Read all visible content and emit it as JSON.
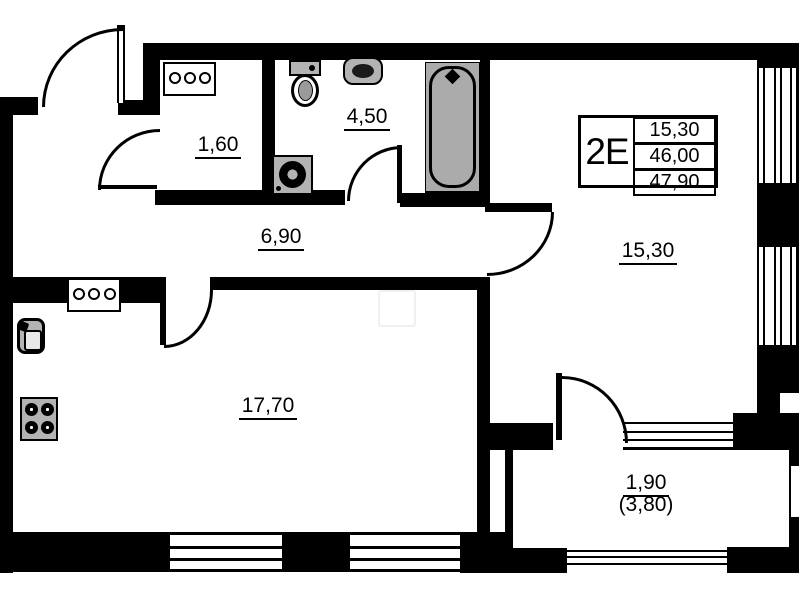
{
  "unit_info": {
    "unit_type": "2E",
    "rows": [
      "15,30",
      "46,00",
      "47,90"
    ]
  },
  "room_labels": {
    "closet": "1,60",
    "bathroom": "4,50",
    "hallway": "6,90",
    "room": "15,30",
    "kitchen_living": "17,70",
    "balcony": "1,90",
    "balcony_total": "(3,80)"
  },
  "colors": {
    "wall": "#000000",
    "fixture_fill": "#b3b3b3",
    "bathtub_fill": "#ababab",
    "background": "#ffffff"
  },
  "symbols": [
    "entrance-door",
    "closet-door",
    "bathroom-door",
    "room-door",
    "kitchen-door",
    "balcony-door",
    "toilet",
    "wash-basin",
    "bathtub",
    "washing-machine",
    "kitchen-sink",
    "stove",
    "electrical-panel",
    "window"
  ]
}
